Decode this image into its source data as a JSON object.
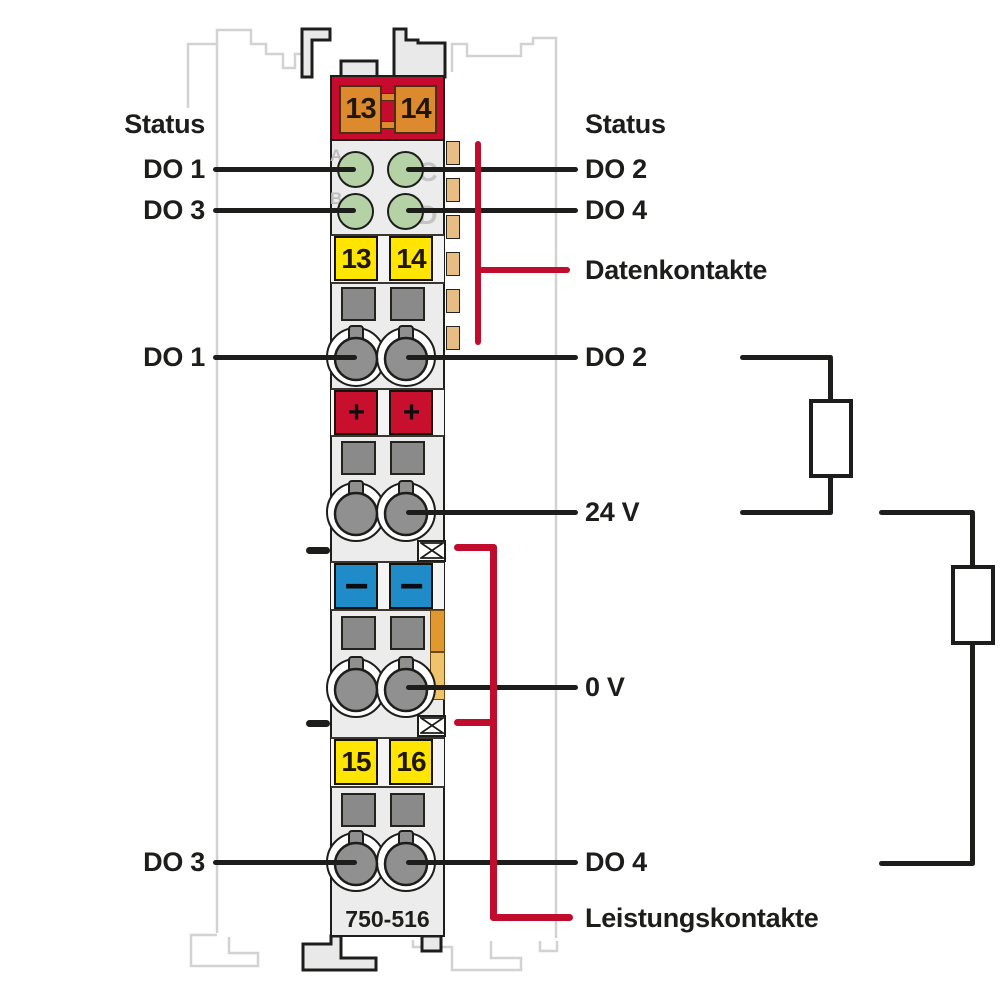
{
  "module": {
    "part_number": "750-516",
    "top_terminal_numbers": [
      "13",
      "14"
    ],
    "signal_terminal_numbers": [
      "13",
      "14"
    ],
    "bottom_terminal_numbers": [
      "15",
      "16"
    ],
    "plus_symbol": "+",
    "minus_symbol": "−",
    "led_letters": [
      "A",
      "B",
      "C",
      "D"
    ]
  },
  "labels": {
    "left": {
      "status": "Status",
      "do1_led": "DO 1",
      "do3_led": "DO 3",
      "do1": "DO 1",
      "do3": "DO 3"
    },
    "right": {
      "status": "Status",
      "do2_led": "DO 2",
      "do4_led": "DO 4",
      "datenkontakte": "Datenkontakte",
      "do2": "DO 2",
      "v24": "24 V",
      "v0": "0 V",
      "do4": "DO 4",
      "leistungskontakte": "Leistungskontakte"
    }
  },
  "colors": {
    "annotation_red": "#c00c2d",
    "header_red": "#c60b2e",
    "clamp_orange": "#dd8a2e",
    "led_green": "#b4d2a6",
    "terminal_yellow": "#ffe500",
    "plus_red": "#c8102e",
    "minus_blue": "#1f8cc9",
    "contact_gray": "#8a8a8a",
    "data_contact_tan": "#e8bd84",
    "power_contact_orange": "#e1992f",
    "line_black": "#1d1d1b",
    "neighbor_gray": "#d2d2d2",
    "body_gray": "#ececec"
  }
}
